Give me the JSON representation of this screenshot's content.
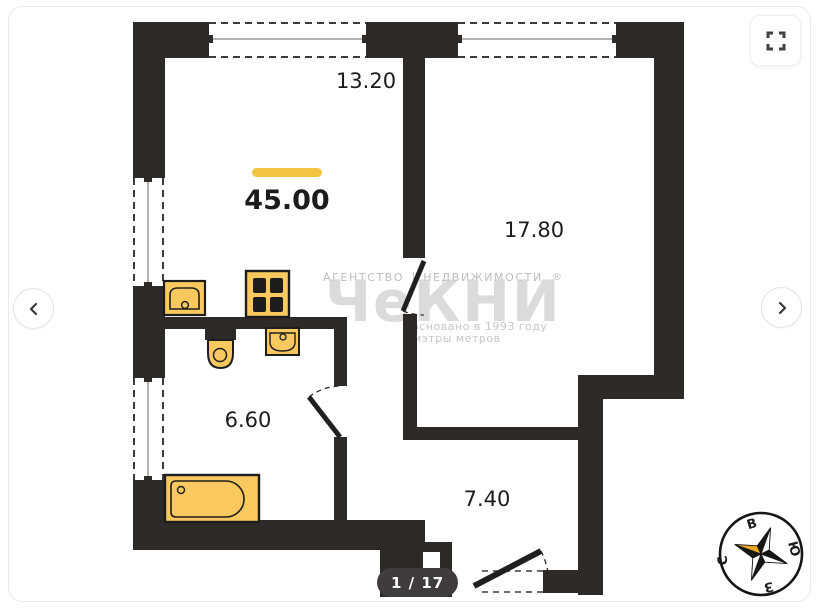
{
  "viewer": {
    "page_indicator": "1 / 17",
    "icons": {
      "prev": "chevron-left-icon",
      "next": "chevron-right-icon",
      "fullscreen": "fullscreen-expand-icon",
      "compass": "compass-rose"
    }
  },
  "plan": {
    "labels": {
      "top_dimension": "13.20",
      "total_area": "45.00",
      "room_large": "17.80",
      "room_bath": "6.60",
      "hallway": "7.40"
    },
    "colors": {
      "wall": "#2d2a28",
      "fixture": "#f9c85e",
      "accent_bar": "#f6c445",
      "compass_gold": "#eda921"
    }
  },
  "watermark": {
    "line1_left": "АГЕНТСТВО",
    "line1_right": "НЕДВИЖИМОСТИ",
    "registered": "®",
    "brand": "ЧеКНИ",
    "founded": "основано в 1993 году",
    "slogan": "мэтры метров"
  },
  "compass": {
    "top": "В",
    "right": "Ю",
    "bottom": "З",
    "left": "С"
  }
}
